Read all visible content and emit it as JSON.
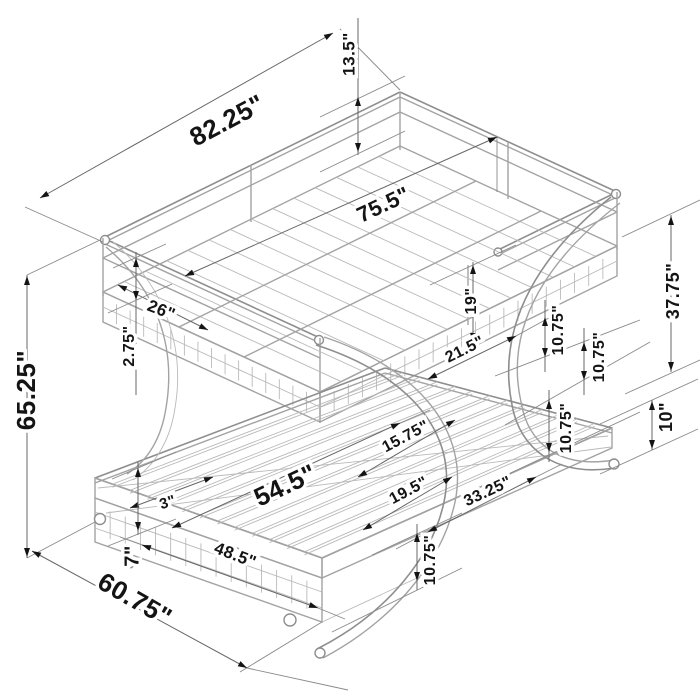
{
  "figure": {
    "type": "isometric dimension diagram",
    "subject": "metal twin-over-futon bunk bed with C-curved tube supports and low base"
  },
  "colors": {
    "background": "#ffffff",
    "bed_line": "#a3a3a3",
    "dim_line": "#676767",
    "arrow": "#141414",
    "text": "#141414"
  },
  "dims": {
    "overall_length": "82.25\"",
    "guard_rail_height": "13.5\"",
    "top_sleep_length": "75.5\"",
    "overall_height": "65.25\"",
    "head_rail_segment": "26\"",
    "side_rail_depth": "2.75\"",
    "under_rail_clearance": "19\"",
    "segment_21_5": "21.5\"",
    "offset_a": "10.75\"",
    "offset_b": "10.75\"",
    "offset_c": "10.75\"",
    "offset_d": "10.75\"",
    "right_side_height": "37.75\"",
    "deck_to_floor": "10\"",
    "segment_15_75": "15.75\"",
    "segment_19_5": "19.5\"",
    "segment_33_25": "33.25\"",
    "bottom_bed_length": "54.5\"",
    "gap_3": "3\"",
    "base_rail_length": "48.5\"",
    "base_rail_height": "7\"",
    "overall_depth": "60.75\""
  }
}
